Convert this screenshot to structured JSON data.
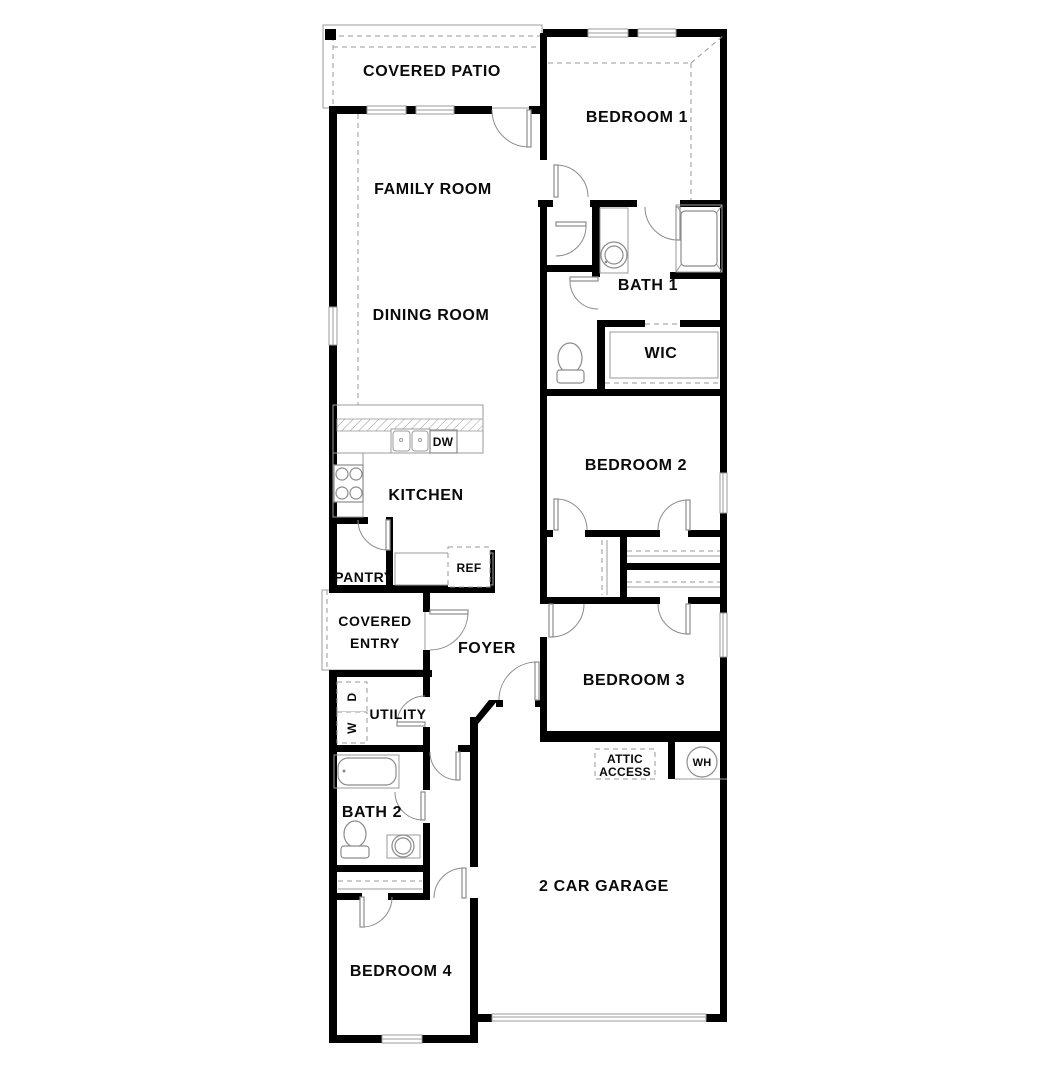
{
  "plan": {
    "title": "Single-story 4-bedroom floor plan",
    "rooms": {
      "covered_patio": "COVERED PATIO",
      "bedroom_1": "BEDROOM 1",
      "family_room": "FAMILY ROOM",
      "bath_1": "BATH 1",
      "wic": "WIC",
      "dining_room": "DINING ROOM",
      "bedroom_2": "BEDROOM 2",
      "kitchen": "KITCHEN",
      "pantry": "PANTRY",
      "covered_entry_1": "COVERED",
      "covered_entry_2": "ENTRY",
      "foyer": "FOYER",
      "bedroom_3": "BEDROOM 3",
      "utility": "UTILITY",
      "bath_2": "BATH 2",
      "garage": "2 CAR GARAGE",
      "bedroom_4": "BEDROOM 4"
    },
    "appliances": {
      "dishwasher": "DW",
      "refrigerator": "REF",
      "water_heater": "WH",
      "dryer": "D",
      "washer": "W",
      "attic_access_1": "ATTIC",
      "attic_access_2": "ACCESS"
    },
    "colors": {
      "wall": "#000000",
      "fixture_line": "#8c8c8c",
      "dashed_line": "#9a9a9a",
      "background": "#ffffff"
    }
  }
}
